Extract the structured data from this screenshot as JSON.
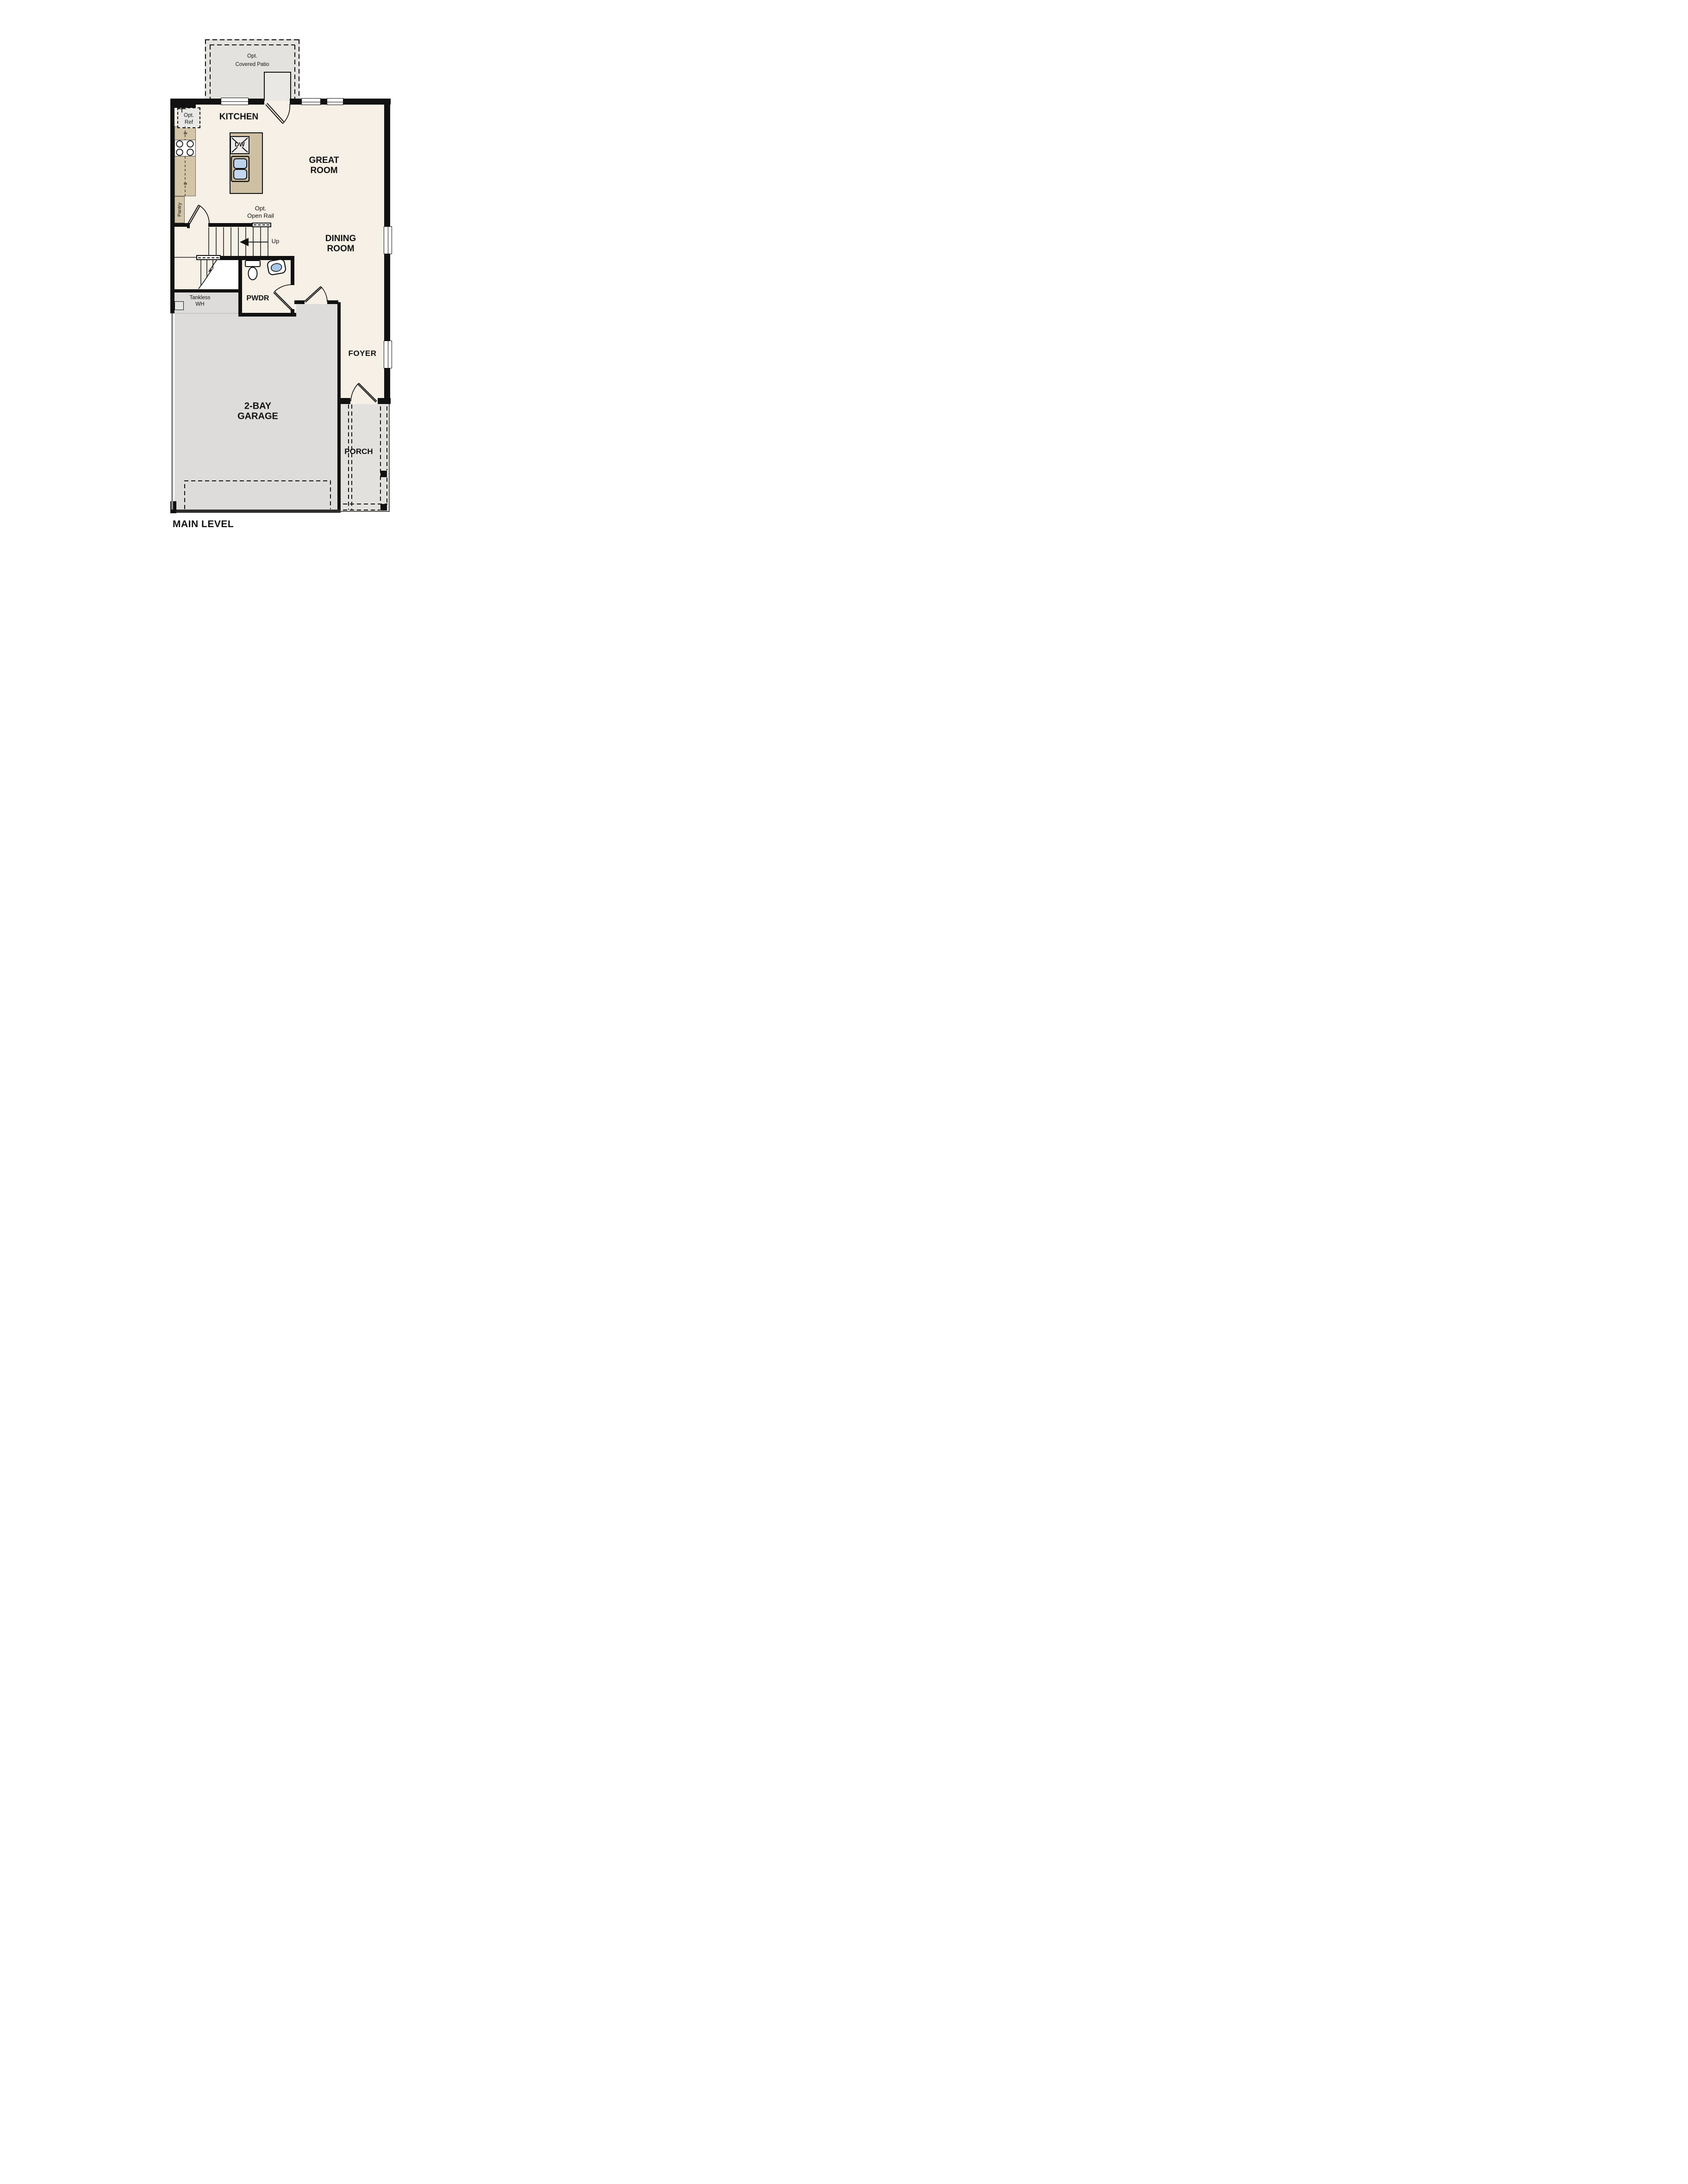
{
  "plan": {
    "title": "MAIN LEVEL",
    "rooms": {
      "kitchen": {
        "label": "KITCHEN"
      },
      "great_room": {
        "line1": "GREAT",
        "line2": "ROOM"
      },
      "dining_room": {
        "line1": "DINING",
        "line2": "ROOM"
      },
      "powder": {
        "label": "PWDR"
      },
      "foyer": {
        "label": "FOYER"
      },
      "garage": {
        "line1": "2-BAY",
        "line2": "GARAGE"
      },
      "porch": {
        "label": "PORCH"
      }
    },
    "annotations": {
      "covered_patio": {
        "line1": "Opt.",
        "line2": "Covered Patio"
      },
      "opt_ref": {
        "line1": "Opt.",
        "line2": "Ref"
      },
      "pantry": {
        "label": "Pantry"
      },
      "open_rail": {
        "line1": "Opt.",
        "line2": "Open Rail"
      },
      "up": {
        "label": "Up"
      },
      "dishwasher": {
        "label": "DW"
      },
      "tankless": {
        "line1": "Tankless",
        "line2": "WH"
      }
    },
    "colors": {
      "floor_cream": "#f7f0e6",
      "patio_gray": "#e4e2df",
      "porch_gray": "#e3e1de",
      "garage_gray": "#dddcda",
      "cabinet_tan": "#d3c5a8",
      "island_tan": "#cec0a3",
      "fixture_blue": "#bdd3ec",
      "sink_blue": "#a9c7e6",
      "wall_black": "#111111"
    }
  }
}
